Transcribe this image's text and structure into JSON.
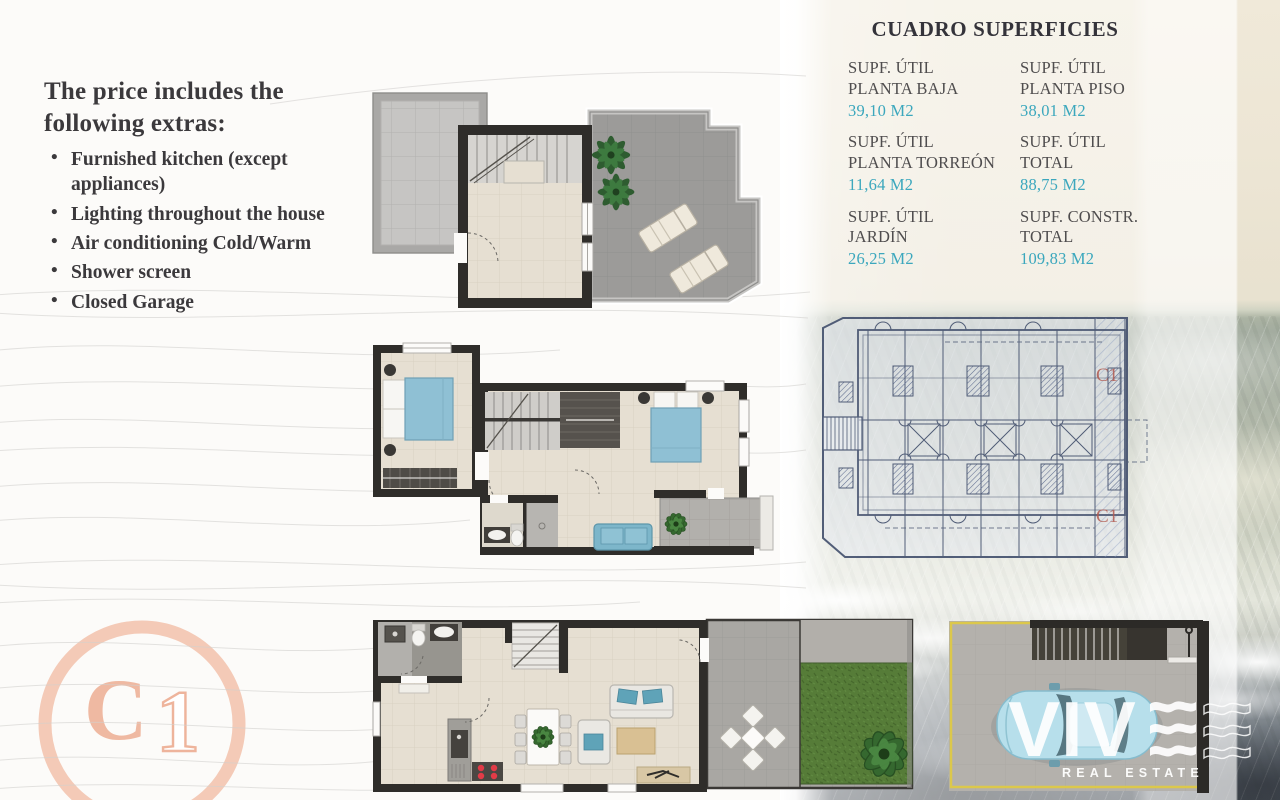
{
  "extras": {
    "heading": "The price includes the following extras:",
    "items": [
      "Furnished kitchen (except appliances)",
      "Lighting throughout the house",
      "Air conditioning Cold/Warm",
      "Shower screen",
      "Closed Garage"
    ]
  },
  "surfaces": {
    "title": "CUADRO SUPERFICIES",
    "cells": [
      {
        "line1": "SUPF. ÚTIL",
        "line2": "PLANTA BAJA",
        "value": "39,10 M2"
      },
      {
        "line1": "SUPF. ÚTIL",
        "line2": "PLANTA PISO",
        "value": "38,01 M2"
      },
      {
        "line1": "SUPF. ÚTIL",
        "line2": "PLANTA TORREÓN",
        "value": "11,64 M2"
      },
      {
        "line1": "SUPF. ÚTIL",
        "line2": "TOTAL",
        "value": "88,75 M2"
      },
      {
        "line1": "SUPF. ÚTIL",
        "line2": "JARDÍN",
        "value": "26,25 M2"
      },
      {
        "line1": "SUPF. CONSTR.",
        "line2": "TOTAL",
        "value": "109,83 M2"
      }
    ]
  },
  "stamp": {
    "letter": "C",
    "digit": "1"
  },
  "site_plan": {
    "unit_labels": [
      "C1",
      "C1"
    ]
  },
  "brand": {
    "word": "VIV",
    "tagline": "REAL ESTATE"
  },
  "colors": {
    "accent_teal": "#3ba7bd",
    "stamp_salmon": "#f0bca6",
    "garage_yellow": "#dcc84b",
    "plan_red_label": "#ae4f44",
    "lawn_green": "#567c38"
  }
}
